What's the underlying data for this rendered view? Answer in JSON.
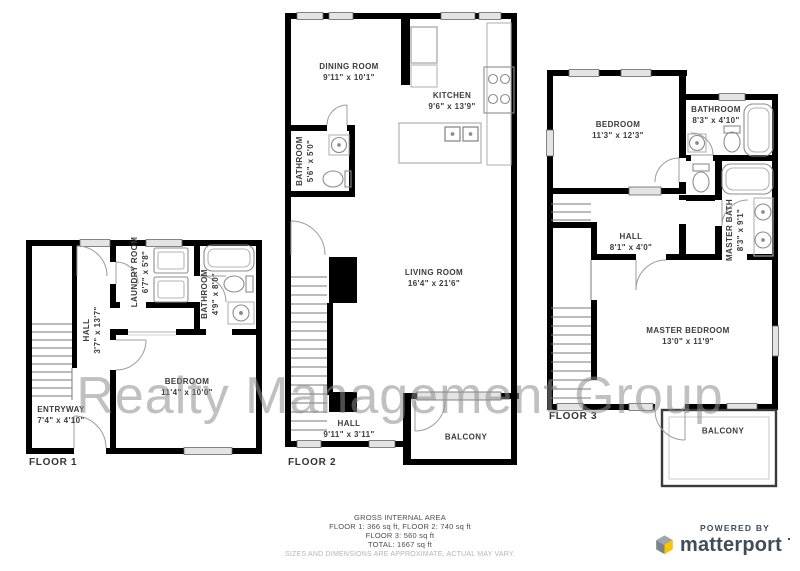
{
  "watermark": "Realty Management Group",
  "floors": [
    {
      "label": "FLOOR 1",
      "rooms": [
        {
          "name": "ENTRYWAY",
          "dims": "7'4\" x 4'10\""
        },
        {
          "name": "HALL",
          "dims": "3'7\" x 13'7\""
        },
        {
          "name": "LAUNDRY ROOM",
          "dims": "6'7\" x 5'8\""
        },
        {
          "name": "BATHROOM",
          "dims": "4'9\" x 8'0\""
        },
        {
          "name": "BEDROOM",
          "dims": "11'4\" x 10'0\""
        }
      ]
    },
    {
      "label": "FLOOR 2",
      "rooms": [
        {
          "name": "DINING ROOM",
          "dims": "9'11\" x 10'1\""
        },
        {
          "name": "KITCHEN",
          "dims": "9'6\" x 13'9\""
        },
        {
          "name": "BATHROOM",
          "dims": "5'6\" x 5'0\""
        },
        {
          "name": "LIVING ROOM",
          "dims": "16'4\" x 21'6\""
        },
        {
          "name": "HALL",
          "dims": "9'11\" x 3'11\""
        },
        {
          "name": "BALCONY",
          "dims": ""
        }
      ]
    },
    {
      "label": "FLOOR 3",
      "rooms": [
        {
          "name": "BEDROOM",
          "dims": "11'3\" x 12'3\""
        },
        {
          "name": "BATHROOM",
          "dims": "8'3\" x 4'10\""
        },
        {
          "name": "HALL",
          "dims": "8'1\" x 4'0\""
        },
        {
          "name": "MASTER BATH",
          "dims": "8'3\" x 9'1\""
        },
        {
          "name": "MASTER BEDROOM",
          "dims": "13'0\" x 11'9\""
        },
        {
          "name": "BALCONY",
          "dims": ""
        }
      ]
    }
  ],
  "footer": {
    "title": "GROSS INTERNAL AREA",
    "line1": "FLOOR 1: 366 sq ft, FLOOR 2: 740 sq ft",
    "line2": "FLOOR 3: 560 sq ft",
    "line3": "TOTAL: 1667 sq ft",
    "disclaimer": "SIZES AND DIMENSIONS ARE APPROXIMATE, ACTUAL MAY VARY."
  },
  "branding": {
    "powered_by": "POWERED BY",
    "name": "matterport"
  },
  "colors": {
    "wall": "#000000",
    "fixture": "#8c8c8c",
    "window_fill": "#e4e4e4",
    "label_text": "#3b3b3b",
    "watermark": "#8c8c8c",
    "brand_navy": "#3e4d57",
    "brand_yellow": "#fdc500"
  }
}
